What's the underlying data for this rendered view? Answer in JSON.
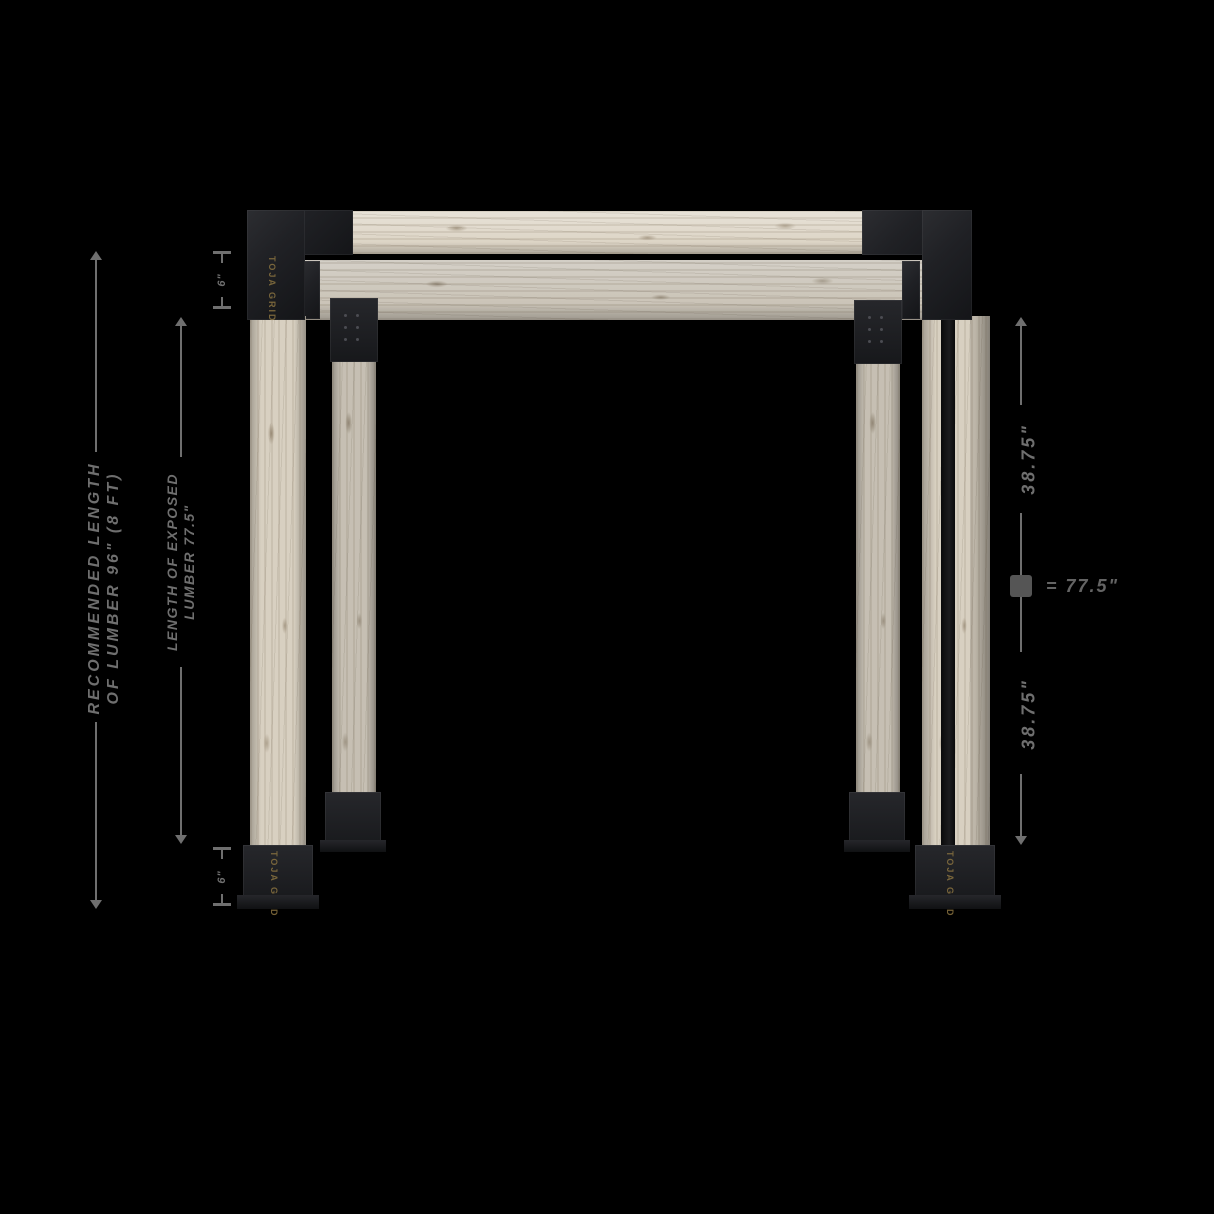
{
  "dimensions": {
    "left_outer": {
      "line1": "RECOMMENDED LENGTH",
      "line2": "OF LUMBER 96\" (8 FT)"
    },
    "left_inner": {
      "line1": "LENGTH OF EXPOSED",
      "line2": "LUMBER 77.5\""
    },
    "right": {
      "upper": "38.75\"",
      "lower": "38.75\"",
      "total": "= 77.5\""
    },
    "top_bracket_height": "6\"",
    "bottom_base_height": "6\""
  },
  "brand": {
    "name": "TOJA GRID"
  },
  "colors": {
    "background": "#000000",
    "dimension_gray": "#6f6f6f",
    "wood_beige": "#d8d0c1",
    "bracket_black": "#1b1c1f",
    "brand_bronze": "#8a7340"
  }
}
